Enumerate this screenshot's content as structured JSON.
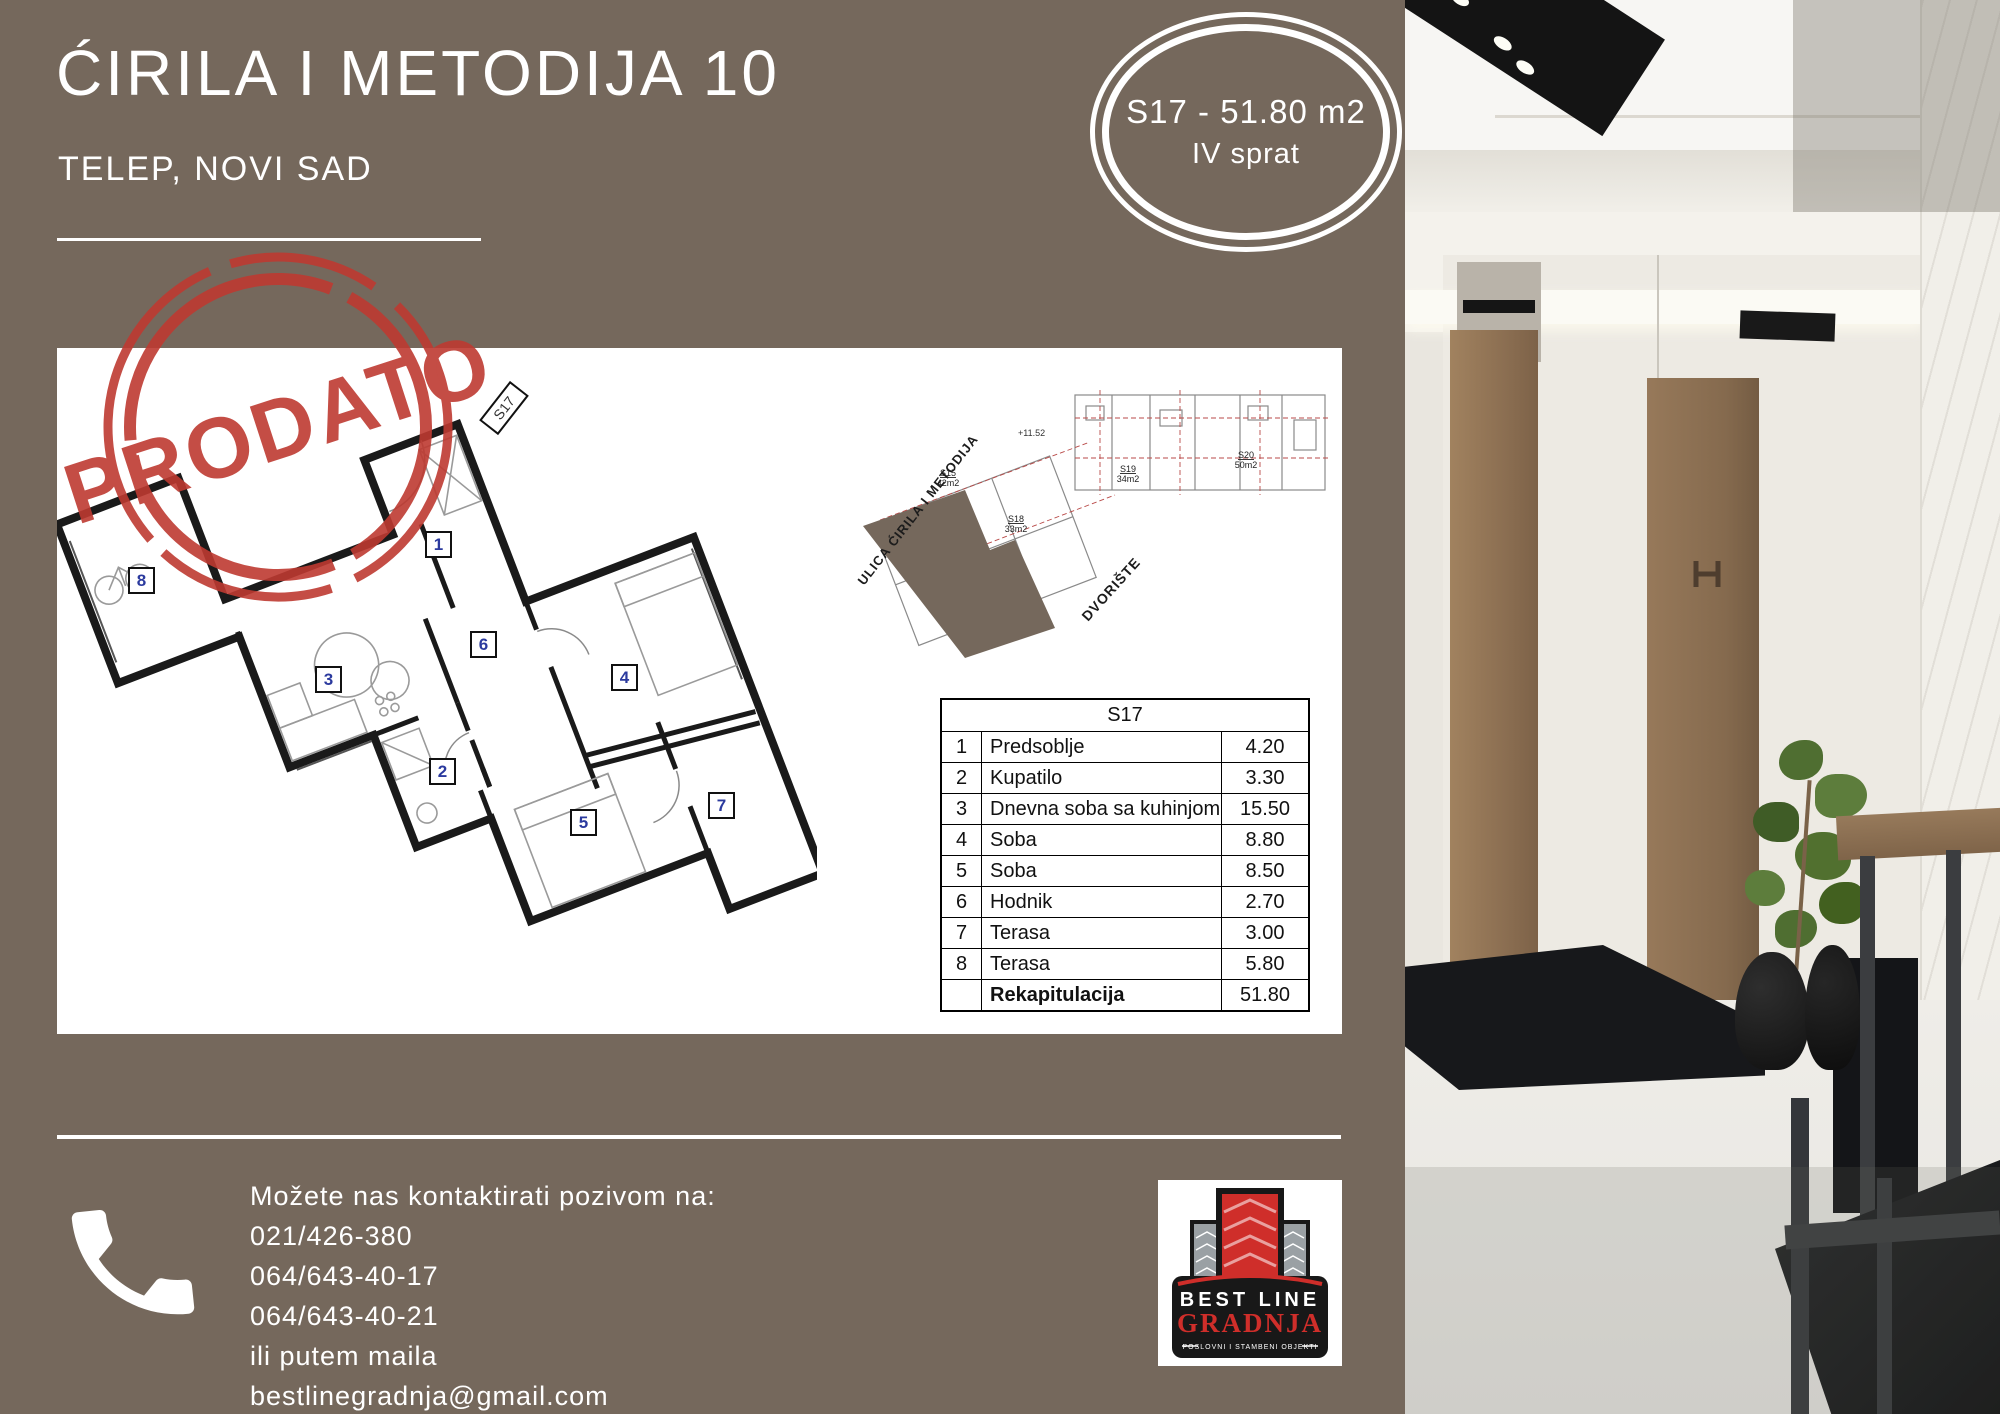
{
  "header": {
    "title": "ĆIRILA I METODIJA 10",
    "subtitle": "TELEP, NOVI SAD",
    "badge": {
      "line1": "S17 - 51.80 m2",
      "line2": "IV sprat"
    }
  },
  "stamp": {
    "text": "PRODATO"
  },
  "floorplan": {
    "unit_flag": "S17",
    "room_labels": [
      "1",
      "2",
      "3",
      "4",
      "5",
      "6",
      "7",
      "8"
    ]
  },
  "siteplan": {
    "street_label": "ULICA ĆIRILA I METODIJA",
    "yard_label": "DVORIŠTE",
    "level_label": "+11.52",
    "units": [
      {
        "id": "S15",
        "area": "42m2"
      },
      {
        "id": "S18",
        "area": "33m2"
      },
      {
        "id": "S19",
        "area": "34m2"
      },
      {
        "id": "S20",
        "area": "50m2"
      }
    ]
  },
  "table": {
    "title": "S17",
    "rows": [
      {
        "num": "1",
        "name": "Predsoblje",
        "value": "4.20"
      },
      {
        "num": "2",
        "name": "Kupatilo",
        "value": "3.30"
      },
      {
        "num": "3",
        "name": "Dnevna soba sa kuhinjom",
        "value": "15.50"
      },
      {
        "num": "4",
        "name": "Soba",
        "value": "8.80"
      },
      {
        "num": "5",
        "name": "Soba",
        "value": "8.50"
      },
      {
        "num": "6",
        "name": "Hodnik",
        "value": "2.70"
      },
      {
        "num": "7",
        "name": "Terasa",
        "value": "3.00"
      },
      {
        "num": "8",
        "name": "Terasa",
        "value": "5.80"
      },
      {
        "num": "",
        "name": "Rekapitulacija",
        "value": "51.80"
      }
    ]
  },
  "contact": {
    "intro": "Možete nas kontaktirati pozivom na:",
    "phones": [
      "021/426-380",
      "064/643-40-17",
      "064/643-40-21"
    ],
    "mail_intro": "ili putem maila",
    "email": "bestlinegradnja@gmail.com"
  },
  "logo": {
    "line1": "BEST LINE",
    "line2": "GRADNJA",
    "tagline": "POSLOVNI I STAMBENI OBJEKTI"
  },
  "colors": {
    "background_brown": "#75685C",
    "stamp_red": "#BE3A31",
    "logo_red": "#CF2E2A"
  }
}
